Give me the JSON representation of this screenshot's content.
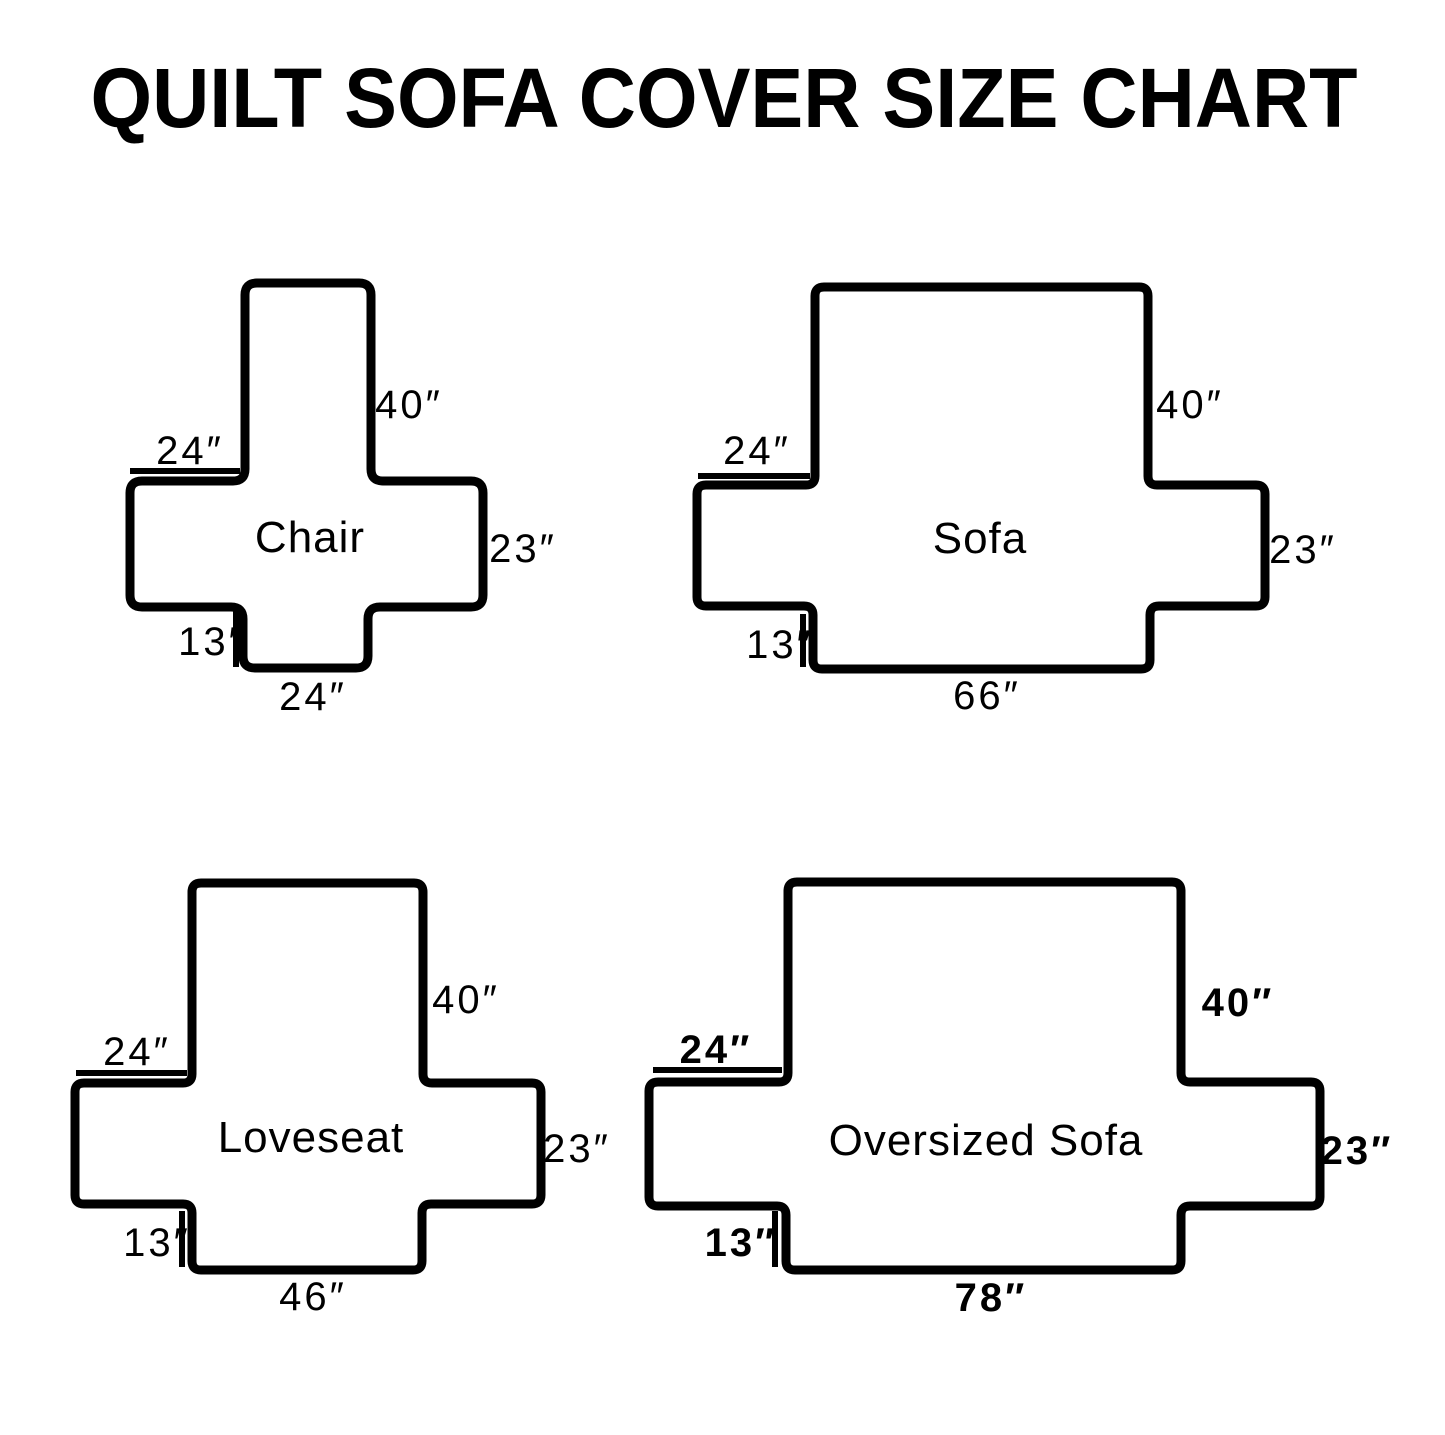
{
  "title": "QUILT SOFA COVER SIZE CHART",
  "colors": {
    "ink": "#000000",
    "background": "#FFFFFF"
  },
  "diagrams": [
    {
      "label": "Chair",
      "back_height": "40″",
      "arm_length": "24″",
      "side_height": "23″",
      "flap_drop": "13″",
      "seat_width": "24″"
    },
    {
      "label": "Sofa",
      "back_height": "40″",
      "arm_length": "24″",
      "side_height": "23″",
      "flap_drop": "13″",
      "seat_width": "66″"
    },
    {
      "label": "Loveseat",
      "back_height": "40″",
      "arm_length": "24″",
      "side_height": "23″",
      "flap_drop": "13″",
      "seat_width": "46″"
    },
    {
      "label": "Oversized Sofa",
      "back_height": "40″",
      "arm_length": "24″",
      "side_height": "23″",
      "flap_drop": "13″",
      "seat_width": "78″"
    }
  ]
}
